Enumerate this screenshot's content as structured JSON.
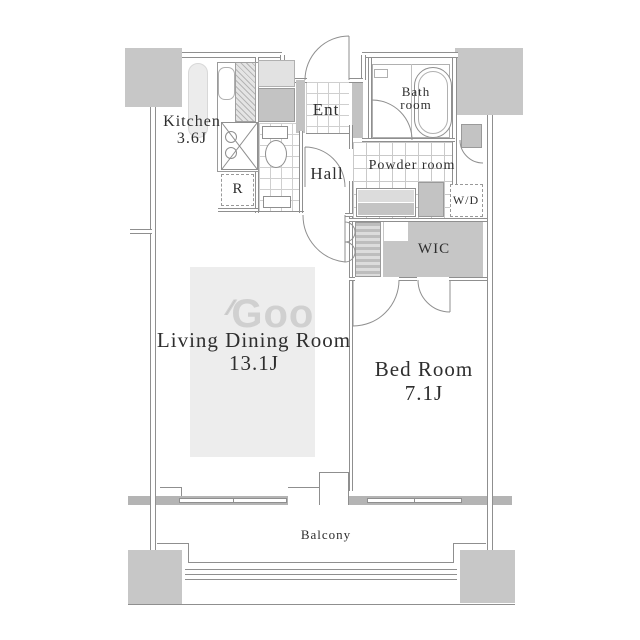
{
  "rooms": {
    "kitchen": {
      "name": "Kitchen",
      "size": "3.6J"
    },
    "entrance": {
      "name": "Ent"
    },
    "bathroom": {
      "name_line1": "Bath",
      "name_line2": "room"
    },
    "hall": {
      "name": "Hall"
    },
    "powder_room": {
      "name": "Powder room"
    },
    "washer_dryer": {
      "name": "W/D"
    },
    "wic": {
      "name": "WIC"
    },
    "refrigerator": {
      "name": "R"
    },
    "living_dining": {
      "name": "Living Dining Room",
      "size": "13.1J"
    },
    "bedroom": {
      "name": "Bed Room",
      "size": "7.1J"
    },
    "balcony": {
      "name": "Balcony"
    }
  },
  "watermark": {
    "text": "Goo",
    "prefix": "⁄⁄"
  },
  "colors": {
    "wall": "#8f8f8f",
    "pillar": "#c7c7c7",
    "window_band": "#b4b4b4",
    "wic_fill": "#c6c6c6",
    "kitchen_counter": "#ececec",
    "rug": "#ededed",
    "tile_line": "#cfcfcf",
    "label_text": "#2e2e2e"
  }
}
